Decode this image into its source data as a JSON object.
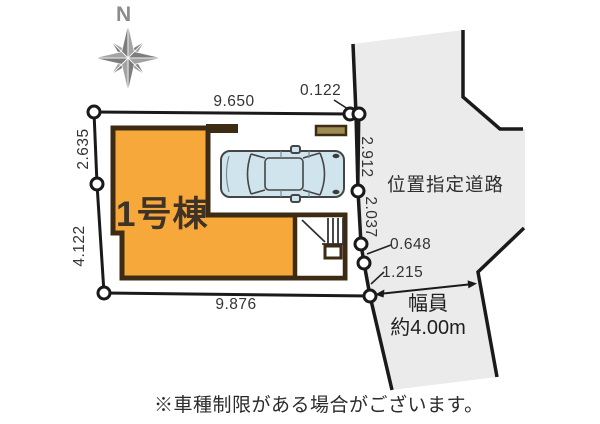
{
  "compass": {
    "label": "N"
  },
  "building": {
    "label": "1号棟"
  },
  "road": {
    "label": "位置指定道路",
    "width_line1": "幅員",
    "width_line2": "約4.00m"
  },
  "dimensions": {
    "top": "9.650",
    "top_right": "0.122",
    "left_upper": "2.635",
    "left_lower": "4.122",
    "right_upper": "2.912",
    "right_lower": "2.037",
    "right_small_upper": "0.648",
    "right_small_lower": "1.215",
    "bottom": "9.876"
  },
  "note": "※車種制限がある場合がございます。",
  "icons": {
    "compass": "compass-rose-icon",
    "car": "car-top-view-icon",
    "stairs": "stairs-icon"
  },
  "colors": {
    "building_fill": "#F7A83A",
    "building_outline": "#3E2B14",
    "road_fill": "#EBEBEB",
    "line_color": "#1A1A1A",
    "car_fill": "#CFE4EC",
    "car_outline": "#454545",
    "wall_fill": "#9C8B52",
    "compass_color": "#8C8C8C",
    "text_color": "#333333"
  }
}
